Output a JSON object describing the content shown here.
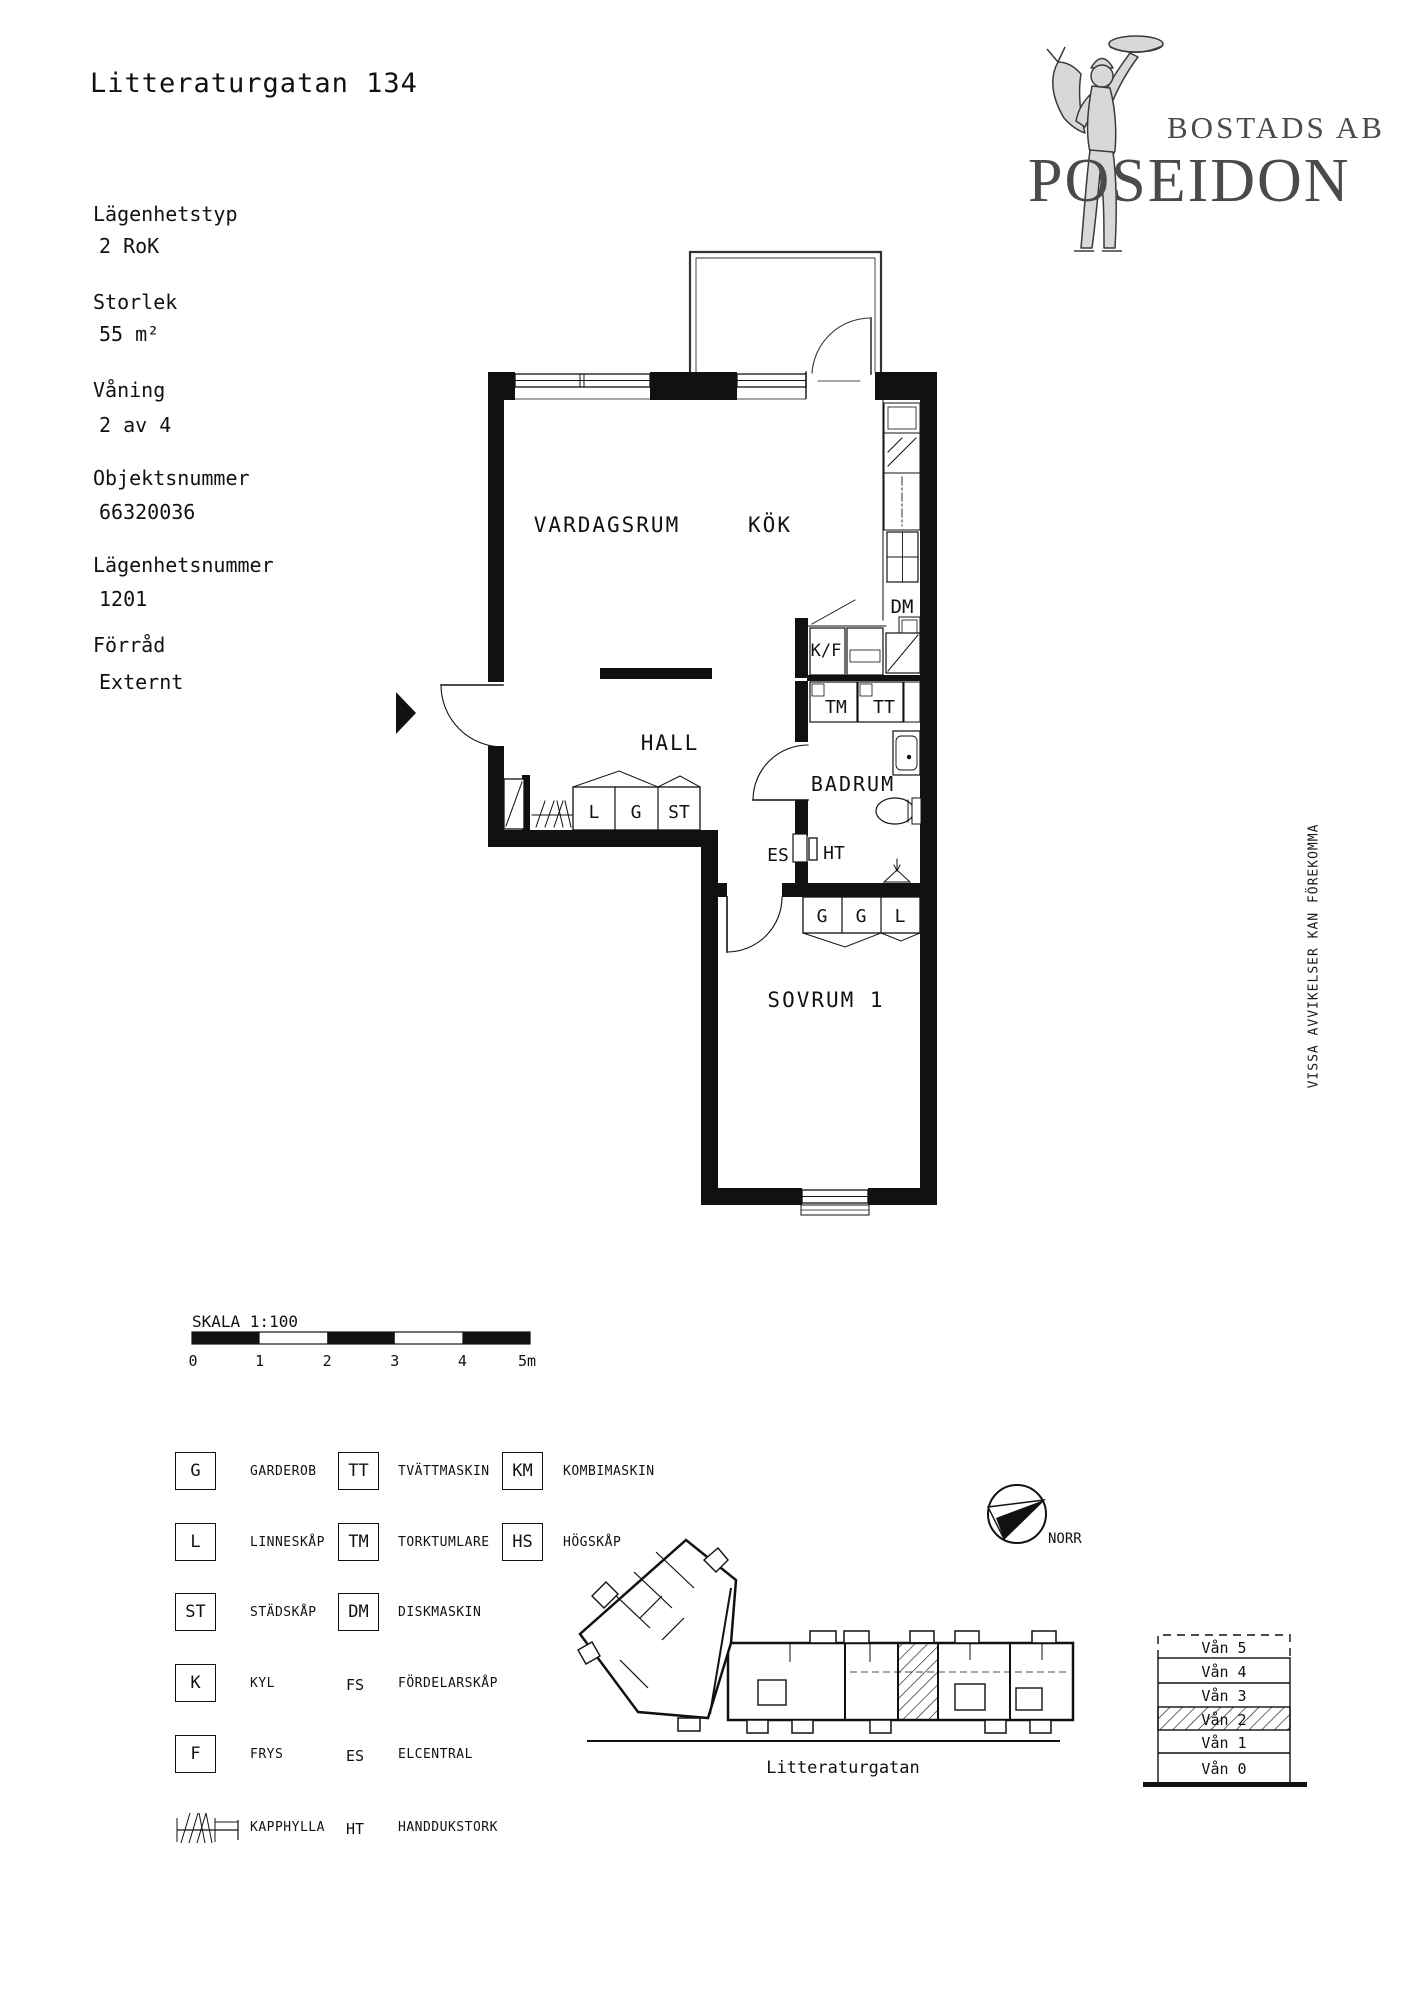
{
  "header": {
    "title": "Litteraturgatan 134"
  },
  "logo": {
    "company_prefix": "BOSTADS AB",
    "company_name": "POSEIDON"
  },
  "sidebar": {
    "fields": [
      {
        "label": "Lägenhetstyp",
        "value": "2 RoK"
      },
      {
        "label": "Storlek",
        "value": "55 m²"
      },
      {
        "label": "Våning",
        "value": "2 av 4"
      },
      {
        "label": "Objektsnummer",
        "value": "66320036"
      },
      {
        "label": "Lägenhetsnummer",
        "value": "1201"
      },
      {
        "label": "Förråd",
        "value": "Externt"
      }
    ]
  },
  "floorplan": {
    "rooms": {
      "living": "VARDAGSRUM",
      "kitchen": "KÖK",
      "hall": "HALL",
      "bathroom": "BADRUM",
      "bedroom": "SOVRUM 1"
    },
    "fixtures": {
      "kf": "K/F",
      "tm": "TM",
      "tt": "TT",
      "dm": "DM",
      "closet_l": "L",
      "closet_g": "G",
      "closet_st": "ST",
      "es": "ES",
      "ht": "HT",
      "bed_g1": "G",
      "bed_g2": "G",
      "bed_l": "L"
    }
  },
  "disclaimer": "VISSA AVVIKELSER KAN FÖREKOMMA",
  "scale": {
    "title": "SKALA 1:100",
    "ticks": [
      "0",
      "1",
      "2",
      "3",
      "4",
      "5m"
    ]
  },
  "legend": {
    "items": [
      {
        "sym": "G",
        "label": "GARDEROB"
      },
      {
        "sym": "L",
        "label": "LINNESKÅP"
      },
      {
        "sym": "ST",
        "label": "STÄDSKÅP"
      },
      {
        "sym": "K",
        "label": "KYL"
      },
      {
        "sym": "F",
        "label": "FRYS"
      },
      {
        "sym": "",
        "label": "KAPPHYLLA"
      },
      {
        "sym": "TT",
        "label": "TVÄTTMASKIN"
      },
      {
        "sym": "TM",
        "label": "TORKTUMLARE"
      },
      {
        "sym": "DM",
        "label": "DISKMASKIN"
      },
      {
        "sym": "FS",
        "label": "FÖRDELARSKÅP"
      },
      {
        "sym": "ES",
        "label": "ELCENTRAL"
      },
      {
        "sym": "HT",
        "label": "HANDDUKSTORK"
      },
      {
        "sym": "KM",
        "label": "KOMBIMASKIN"
      },
      {
        "sym": "HS",
        "label": "HÖGSKÅP"
      }
    ]
  },
  "compass": {
    "label": "NORR"
  },
  "siteplan": {
    "street_label": "Litteraturgatan"
  },
  "floor_stack": {
    "levels": [
      "Vån 5",
      "Vån 4",
      "Vån 3",
      "Vån 2",
      "Vån 1",
      "Vån 0"
    ]
  }
}
